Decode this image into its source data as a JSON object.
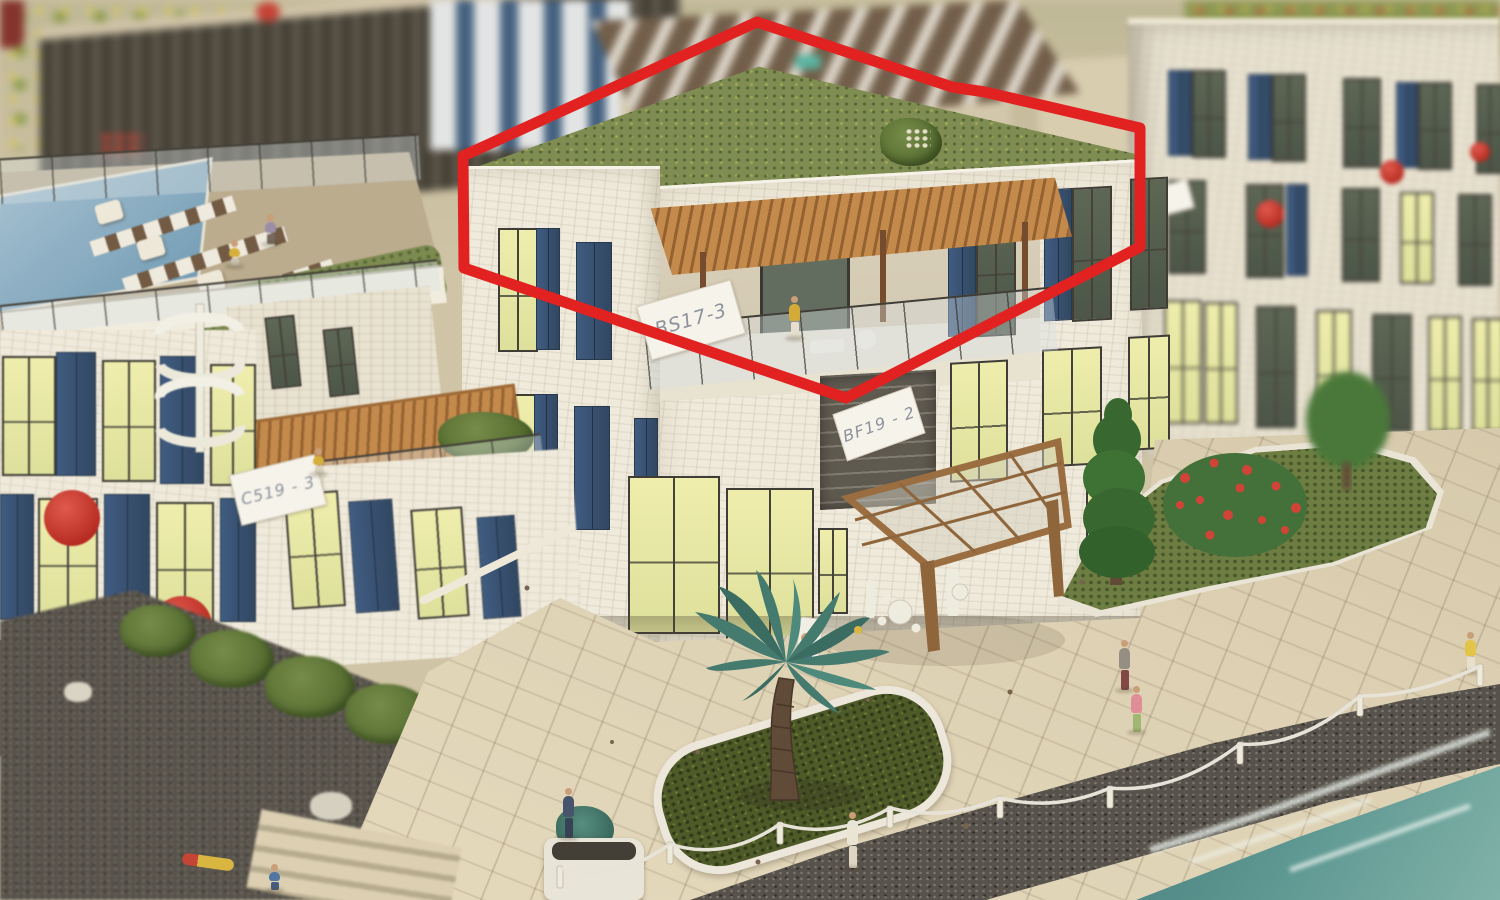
{
  "scene": {
    "subject": "Architectural scale model photo of a seaside apartment complex; a red 3D box outline highlights a corner penthouse unit with a green roof and wooden pergola terrace",
    "annotation": {
      "shape": "3d-box-outline",
      "color": "#e11717",
      "highlighted_unit_label": "BS17-3"
    }
  },
  "labels": {
    "center_unit": "BS17-3",
    "left_upper_unit": "C519 - 3",
    "left_lower_unit": "C521 - 3",
    "right_mid_unit": "BF19 - 2"
  },
  "palette": {
    "stone": "#f0ebdd",
    "shutters": "#2f4a6e",
    "lit_window": "#e9e9ab",
    "green_roof": "#79894c",
    "pergola_wood": "#c28546",
    "paving": "#d9cdb0",
    "deep_water": "#1e4a52",
    "annotation_red": "#e11717"
  }
}
